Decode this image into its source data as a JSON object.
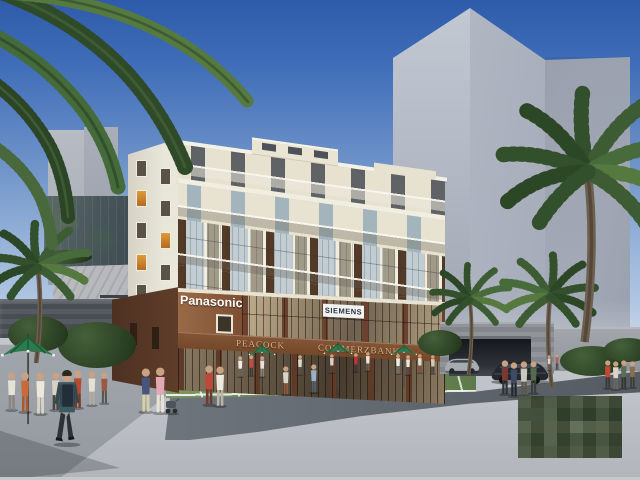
{
  "scene": {
    "type": "architectural-rendering",
    "signs": {
      "panasonic": "Panasonic",
      "siemens": "SIEMENS",
      "peacock": "PEACOCK",
      "commerzbank": "COMMERZBANK"
    },
    "palette": {
      "sky_top": "#2e5cab",
      "sky_horizon": "#c6d6ea",
      "building_cream": "#e8e2d1",
      "podium_brown": "#8a5a3d",
      "sign_gold": "#d3b68c",
      "umbrella_green": "#2e7a4e",
      "grass_dark": "#2b4119",
      "plaza_gray": "#c4c8ce",
      "tower_gray": "#aab0bc",
      "palm_green": "#3d5c34"
    },
    "watermark": {
      "style": "pixelated-mosaic"
    },
    "people": [
      [
        12,
        412,
        40,
        "#e6e2d6",
        "#8a8580"
      ],
      [
        25,
        414,
        42,
        "#c96a38",
        "#a85a30"
      ],
      [
        40,
        416,
        44,
        "#ece8dc",
        "#d8d4c8"
      ],
      [
        56,
        412,
        40,
        "#d8d2c6",
        "#4a4540"
      ],
      [
        78,
        410,
        40,
        "#b84a30",
        "#7a3a28"
      ],
      [
        92,
        407,
        36,
        "#e4e0d4",
        "#b0aca0"
      ],
      [
        104,
        405,
        33,
        "#9a5a42",
        "#5a5550"
      ],
      [
        146,
        414,
        46,
        "#46557e",
        "#d8cfa8"
      ],
      [
        160,
        415,
        48,
        "#e2a8b4",
        "#e8e2d4"
      ],
      [
        209,
        407,
        42,
        "#c04838",
        "#70392e"
      ],
      [
        220,
        408,
        42,
        "#eceadf",
        "#b8b4a8"
      ],
      [
        286,
        396,
        30,
        "#d8d4c8",
        "#8a5a3a"
      ],
      [
        314,
        394,
        30,
        "#9ab0c4",
        "#55606e"
      ],
      [
        240,
        378,
        22,
        "#f2efe8",
        "#6a655e"
      ],
      [
        251,
        377,
        22,
        "#c44a42",
        "#3c3a36"
      ],
      [
        262,
        378,
        22,
        "#e8e4da",
        "#8a857c"
      ],
      [
        300,
        376,
        21,
        "#dcd8cc",
        "#56524a"
      ],
      [
        332,
        374,
        20,
        "#d8d2c8",
        "#4a463e"
      ],
      [
        356,
        373,
        20,
        "#c23040",
        "#3a3632"
      ],
      [
        368,
        372,
        20,
        "#ece8dc",
        "#6e6a60"
      ],
      [
        398,
        375,
        21,
        "#f0ede4",
        "#7a756c"
      ],
      [
        408,
        376,
        21,
        "#e8e5da",
        "#565248"
      ],
      [
        420,
        374,
        20,
        "#e2ded2",
        "#8a4a3a"
      ],
      [
        433,
        375,
        20,
        "#d8c8b8",
        "#44403a"
      ],
      [
        505,
        396,
        36,
        "#7a3a34",
        "#2e3338"
      ],
      [
        514,
        398,
        36,
        "#3c4a64",
        "#23282e"
      ],
      [
        524,
        397,
        36,
        "#ccc8c0",
        "#5a564e"
      ],
      [
        534,
        395,
        34,
        "#566a4c",
        "#3a3e34"
      ],
      [
        608,
        390,
        30,
        "#c44838",
        "#3c3832"
      ],
      [
        616,
        391,
        30,
        "#dcd4c8",
        "#6a665e"
      ],
      [
        624,
        390,
        30,
        "#5c6c56",
        "#32362e"
      ],
      [
        632,
        389,
        28,
        "#8a6c4e",
        "#403c34"
      ],
      [
        549,
        371,
        16,
        "#d8d4cc",
        "#6a665e"
      ],
      [
        557,
        370,
        16,
        "#a8645a",
        "#44403a"
      ]
    ],
    "umbrellas": [
      [
        28,
        334,
        62,
        42
      ],
      [
        262,
        344,
        40,
        28
      ],
      [
        338,
        342,
        42,
        29
      ],
      [
        404,
        344,
        40,
        27
      ]
    ],
    "palms": [
      [
        38,
        268,
        0.95,
        1
      ],
      [
        470,
        300,
        0.75,
        1
      ],
      [
        550,
        297,
        0.9,
        -1
      ],
      [
        588,
        172,
        1.7,
        1
      ]
    ],
    "bushes": [
      [
        58,
        322,
        78,
        46
      ],
      [
        8,
        316,
        60,
        36
      ],
      [
        418,
        330,
        44,
        26
      ],
      [
        560,
        346,
        64,
        30
      ],
      [
        604,
        338,
        48,
        24
      ],
      [
        40,
        250,
        52,
        14
      ]
    ]
  }
}
